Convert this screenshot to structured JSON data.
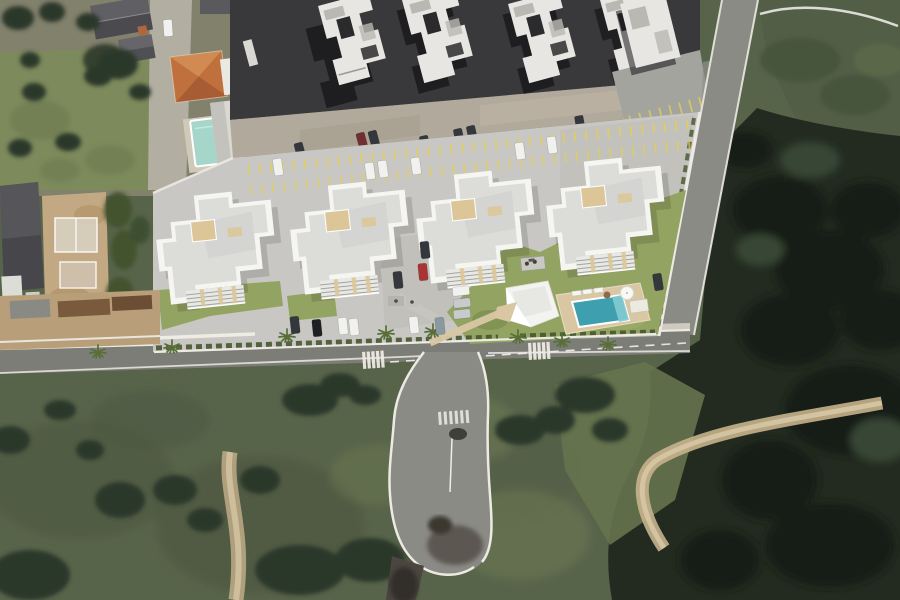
{
  "meta": {
    "view": "aerial-satellite-composite",
    "description": "Top-down satellite photo with 3D architectural render of a residential condominium site: four white apartment buildings, parking areas, pool deck with leisure area, access street with cul-de-sac loop, surrounded by existing neighborhood and dense vegetation"
  },
  "scene": {
    "features": [
      "four rendered apartment buildings",
      "existing apartment blocks row (top)",
      "houses with gray and orange roofs (top-left)",
      "internal parking road with yellow bay markings",
      "parked cars",
      "swimming pool with wooden deck, loungers and umbrella",
      "clubhouse",
      "lawns, hedges and palm trees",
      "public street with crosswalks and dashed centerline",
      "cul-de-sac loop road",
      "diagonal perimeter road (right)",
      "dense forest and scrubland",
      "dirt trails"
    ]
  },
  "palette": {
    "scrub": "#58644a",
    "field": "#7d8a5c",
    "ground": "#82816c",
    "driveway": "#b2aea2",
    "old_asphalt": "#39393b",
    "concrete": "#b1a99b",
    "block_white": "#e7e6e2",
    "block_roof": "#b9b8b3",
    "notch_dark": "#2b2b2e",
    "shadow": "#16161a",
    "roof_gray_house": "#5a5a5e",
    "roof_orange": "#c0703c",
    "orange_light": "#d08a52",
    "orange_dark": "#a85c33",
    "old_pool": "#a5d6c9",
    "pavement": "#c8c7c3",
    "pavement_shade": "#bcbbb6",
    "yellow": "#e5cf55",
    "bldg_white": "#f5f5f2",
    "roof_light": "#dcdcd9",
    "roof_mid": "#d2d2cf",
    "beige": "#dcc697",
    "balcony_gray": "#a3a39f",
    "lawn": "#93a362",
    "hedge": "#47572f",
    "palm": "#55713a",
    "deck": "#d9c7a3",
    "pool": "#3ea0af",
    "pool_step": "#83cad2",
    "road": "#8b8b86",
    "road_dark": "#7d7d78",
    "curb": "#eceae3",
    "sidewalk": "#cfcabf",
    "dirt": "#c7b28c",
    "dirt_light": "#dbcba9",
    "forest": "#232b20",
    "forest_deep": "#151c14",
    "tree": "#2c372a",
    "olive": "#525f46",
    "olive_light": "#66734e",
    "dirt_construction": "#c2a983",
    "compound_tan": "#b99f79",
    "roof_brown": "#7a5a3c",
    "car_white": "#f1f1ef",
    "car_silver": "#c7cbce",
    "car_dark": "#34373c",
    "car_black": "#1e2023",
    "car_red": "#a83434",
    "car_darkred": "#6e3034",
    "car_bluegray": "#8a98a0",
    "loop_sub": "#4c4640"
  }
}
